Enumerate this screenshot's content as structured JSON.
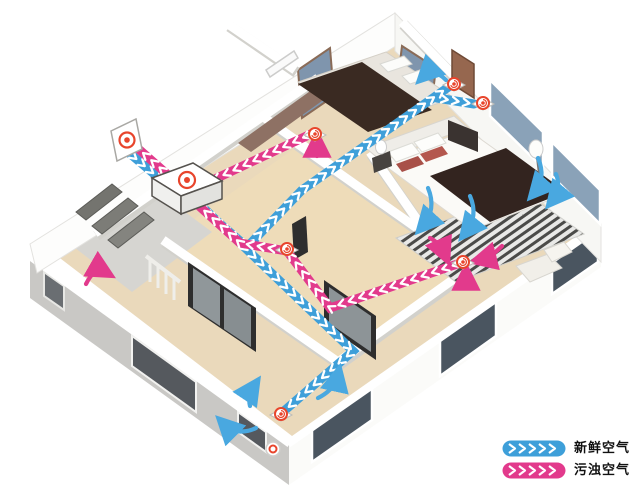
{
  "legend": {
    "items": [
      {
        "id": "fresh-air",
        "label": "新鲜空气",
        "color": "#3e9fd9"
      },
      {
        "id": "polluted-air",
        "label": "污浊空气",
        "color": "#e23a8c"
      }
    ]
  },
  "colors": {
    "fresh_air": "#3e9fd9",
    "polluted_air": "#e23a8c",
    "vent_ring": "#e8452c",
    "floor_wood": "#ead9bb",
    "floor_gray": "#d6d5d1",
    "wall_white": "#ffffff",
    "wall_gray": "#c9c8c5",
    "window_blue": "#8aa2b8",
    "window_dark": "#4a5560"
  },
  "icons": {
    "supply_vent": "air-vent-icon",
    "exhaust_vent": "air-vent-icon",
    "wall_vent": "wall-intake-vent-icon",
    "unit": "heat-recovery-unit-icon",
    "duct_arrow": "chevron-icon"
  }
}
